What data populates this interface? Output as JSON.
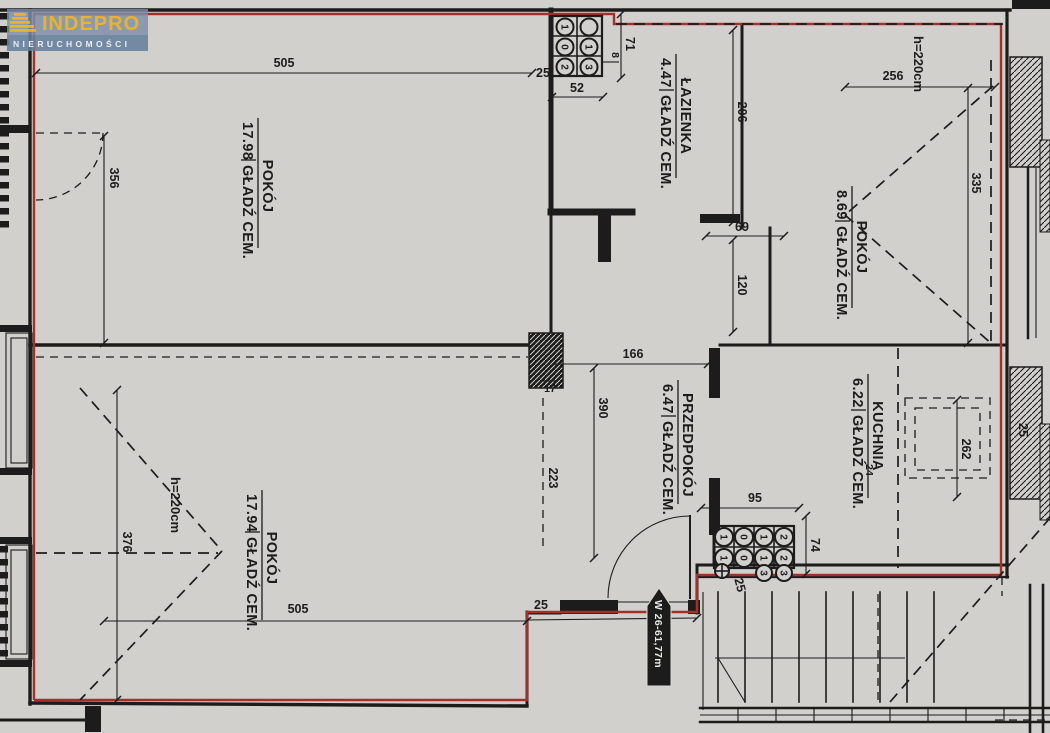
{
  "brand": {
    "name": "INDEPRO",
    "tagline": "NIERUCHOMOŚCI"
  },
  "rooms": [
    {
      "name": "POKÓJ",
      "area": "17.98",
      "finish": "GŁADŹ CEM."
    },
    {
      "name": "ŁAZIENKA",
      "area": "4.47",
      "finish": "GŁADŹ CEM."
    },
    {
      "name": "POKÓJ",
      "area": "8.69",
      "finish": "GŁADŹ CEM."
    },
    {
      "name": "KUCHNIA",
      "area": "6.22",
      "finish": "GŁADŹ CEM."
    },
    {
      "name": "PRZEDPOKÓJ",
      "area": "6.47",
      "finish": "GŁADŹ CEM."
    },
    {
      "name": "POKÓJ",
      "area": "17.94",
      "finish": "GŁADŹ CEM."
    }
  ],
  "heights": {
    "left": "h=220cm",
    "right": "h=220cm"
  },
  "entrance": {
    "label": "W 26-61,77m"
  },
  "dims": {
    "w505_top": "505",
    "t25_top": "25",
    "w52": "52",
    "h71": "71",
    "g8": "8",
    "h206": "206",
    "w69": "69",
    "h120": "120",
    "w166": "166",
    "h390": "390",
    "t17": "17",
    "h223": "223",
    "h356": "356",
    "h376": "376",
    "w505_bottom": "505",
    "t25_bottom": "25",
    "w256": "256",
    "h335": "335",
    "k24": "24",
    "k262": "262",
    "k25": "25",
    "r95": "95",
    "r74": "74",
    "r25": "25"
  },
  "risers": {
    "top": [
      [
        "1",
        ""
      ],
      [
        "0",
        "1"
      ],
      [
        "2",
        "3"
      ]
    ],
    "bottom": [
      [
        "1",
        "0",
        "1",
        "2"
      ],
      [
        "1",
        "0",
        "1",
        "2"
      ],
      [
        "3",
        "3"
      ]
    ]
  },
  "colors": {
    "boundary_red": "#a3312a",
    "ink": "#1c1c1c",
    "paper": "#d1d0cc",
    "logo_blue": "#7c8ea9",
    "logo_yellow": "#e9b428"
  }
}
